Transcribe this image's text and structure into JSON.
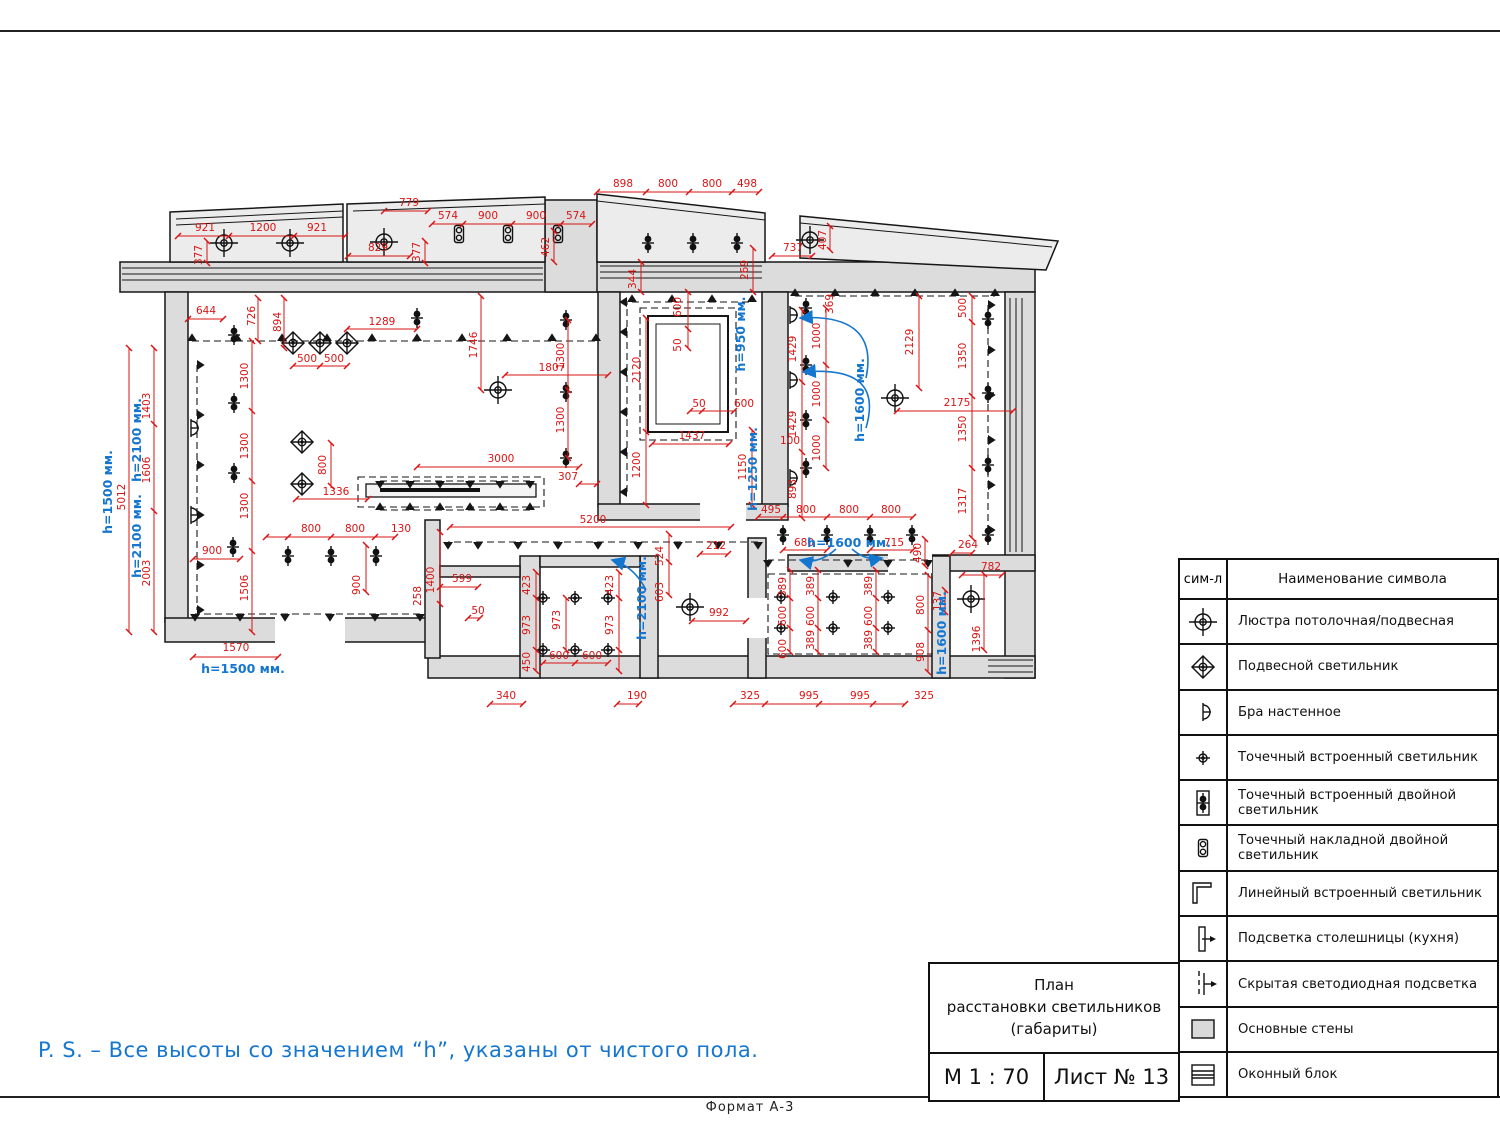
{
  "page": {
    "footer": "Формат А-3",
    "note": "P. S. – Все высоты со значением “h”, указаны от чистого пола."
  },
  "titleblock": {
    "title_line1": "План",
    "title_line2": "расстановки светильников",
    "title_line3": "(габариты)",
    "scale": "М 1 : 70",
    "sheet": "Лист № 13"
  },
  "legend": {
    "header_symbol": "сим-л",
    "header_name": "Наименование символа",
    "rows": [
      {
        "symbol": "chandelier",
        "label": "Люстра потолочная/подвесная"
      },
      {
        "symbol": "pendant-light",
        "label": "Подвесной светильник"
      },
      {
        "symbol": "wall-sconce",
        "label": "Бра настенное"
      },
      {
        "symbol": "recessed-spot",
        "label": "Точечный встроенный светильник"
      },
      {
        "symbol": "recessed-double-spot",
        "label": "Точечный встроенный двойной светильник"
      },
      {
        "symbol": "surface-double-spot",
        "label": "Точечный накладной двойной светильник"
      },
      {
        "symbol": "linear-recessed",
        "label": "Линейный встроенный светильник"
      },
      {
        "symbol": "countertop-light",
        "label": "Подсветка столешницы (кухня)"
      },
      {
        "symbol": "hidden-led",
        "label": "Скрытая светодиодная подсветка"
      },
      {
        "symbol": "main-walls",
        "label": "Основные стены"
      },
      {
        "symbol": "window-block",
        "label": "Оконный блок"
      }
    ]
  },
  "colors": {
    "dimension": "#d91414",
    "height_note": "#1476cf",
    "walls": "#dcdcdc"
  },
  "plan": {
    "dims": [
      "921",
      "1200",
      "921",
      "377",
      "779",
      "829",
      "377",
      "574",
      "900",
      "900",
      "574",
      "462",
      "898",
      "800",
      "800",
      "498",
      "344",
      "269",
      "737",
      "407",
      "644",
      "726",
      "894",
      "1289",
      "500",
      "500",
      "1746",
      "1807",
      "1300",
      "1300",
      "1403",
      "1606",
      "2003",
      "5012",
      "1300",
      "1300",
      "1300",
      "1506",
      "800",
      "1336",
      "3000",
      "307",
      "800",
      "800",
      "130",
      "900",
      "900",
      "1570",
      "1400",
      "599",
      "50",
      "258",
      "5200",
      "524",
      "603",
      "212",
      "992",
      "600",
      "50",
      "2120",
      "50",
      "600",
      "1437",
      "1200",
      "1150",
      "423",
      "973",
      "423",
      "973",
      "973",
      "450",
      "600",
      "600",
      "340",
      "190",
      "369",
      "1000",
      "1000",
      "1000",
      "1429",
      "1429",
      "100",
      "893",
      "495",
      "800",
      "800",
      "800",
      "680",
      "715",
      "490",
      "264",
      "782",
      "389",
      "389",
      "389",
      "600",
      "600",
      "600",
      "389",
      "389",
      "600",
      "800",
      "908",
      "137",
      "1396",
      "995",
      "995",
      "325",
      "325",
      "2129",
      "500",
      "1350",
      "2175",
      "1350",
      "1317"
    ],
    "heights": [
      "h=1500 мм.",
      "h=2100 мм.",
      "h=2100 мм.",
      "h=1500 мм.",
      "h=950 мм.",
      "h=1250 мм.",
      "h=1600 мм.",
      "h=1600 мм.",
      "h=1600 мм.",
      "h=2100 мм."
    ]
  }
}
